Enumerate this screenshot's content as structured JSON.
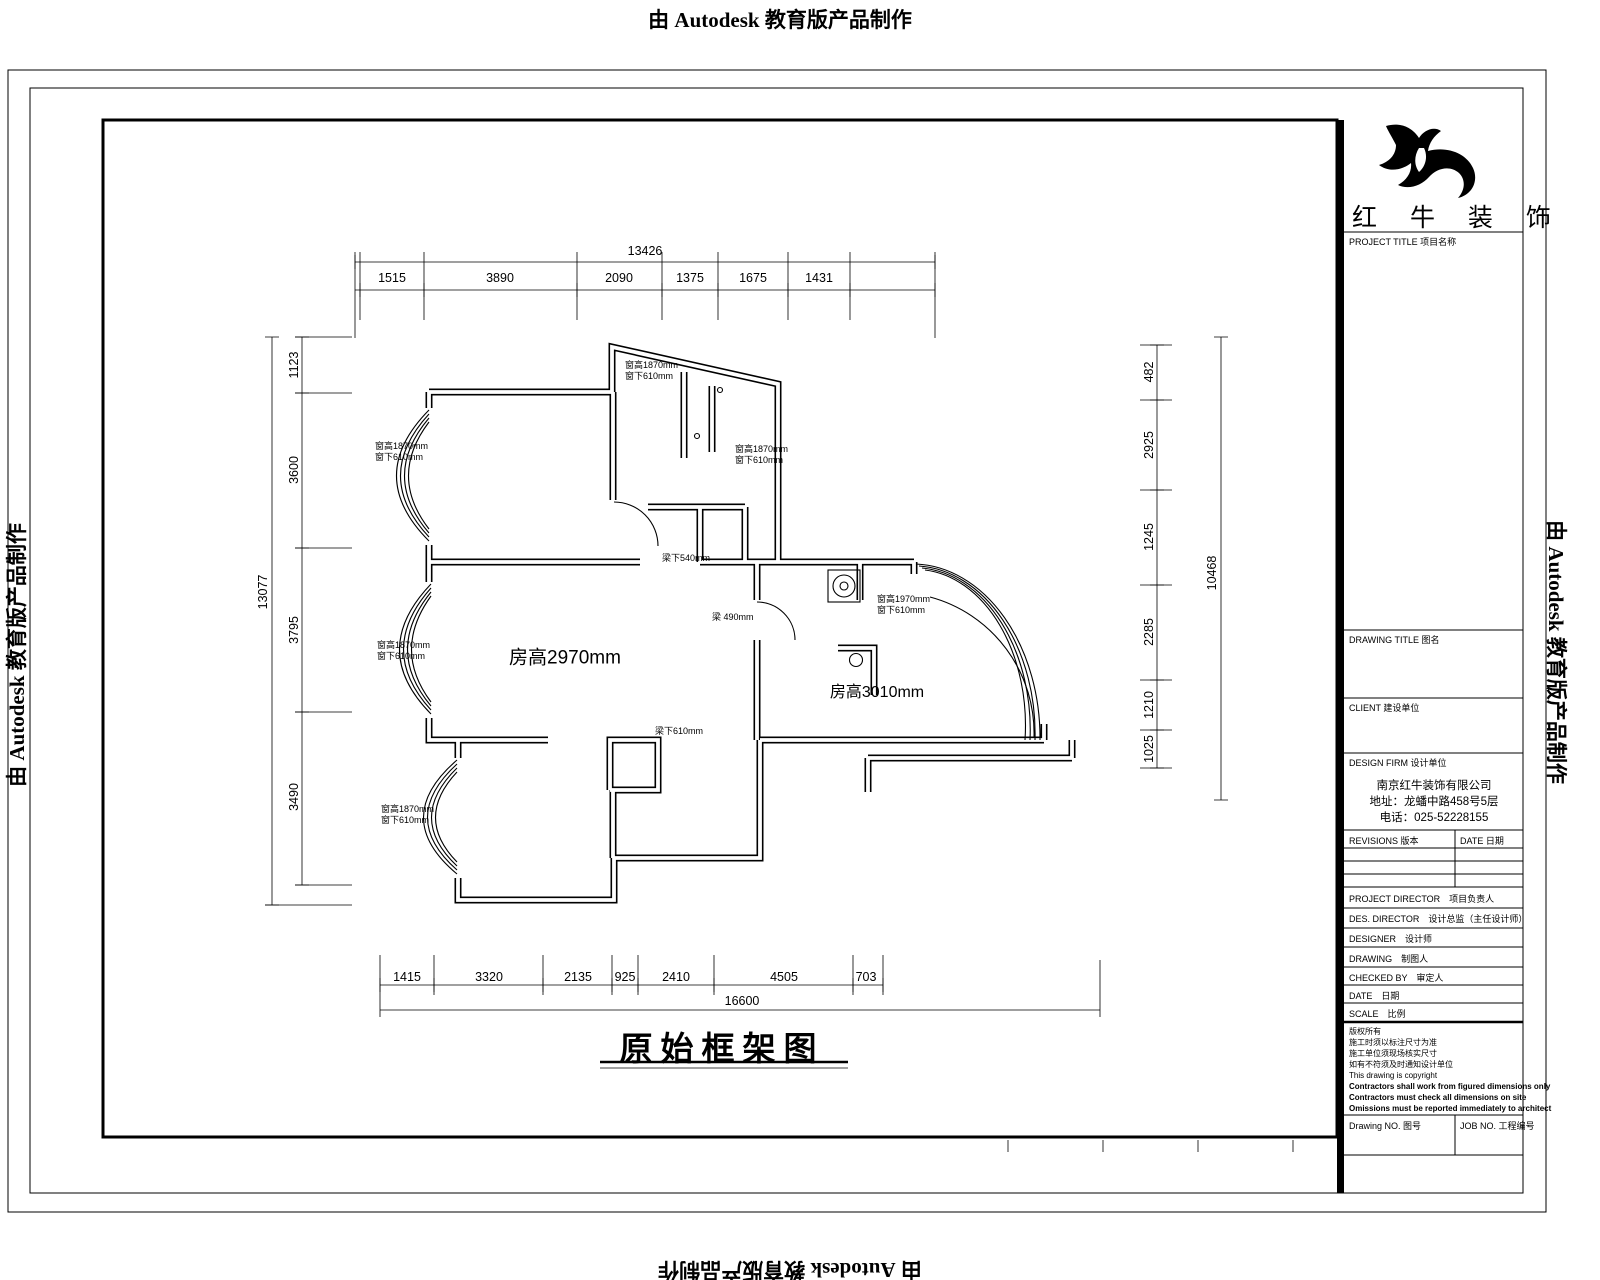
{
  "watermark": {
    "text": "由 Autodesk 教育版产品制作"
  },
  "plan": {
    "title": "原始框架图",
    "rooms": [
      {
        "label": "房高2970mm"
      },
      {
        "label": "房高3010mm"
      }
    ],
    "annotations": [
      {
        "l1": "窗高1870mm",
        "l2": "窗下610mm"
      },
      {
        "l1": "窗高1870mm",
        "l2": "窗下610mm"
      },
      {
        "l1": "窗高1870mm",
        "l2": "窗下610mm"
      },
      {
        "l1": "窗高1870mm",
        "l2": "窗下610mm"
      },
      {
        "l1": "窗高1870mm",
        "l2": "窗下610mm"
      },
      {
        "l1": "窗高1970mm",
        "l2": "窗下610mm"
      },
      {
        "l1": "梁下540mm",
        "l2": ""
      },
      {
        "l1": "梁 490mm",
        "l2": ""
      },
      {
        "l1": "梁下610mm",
        "l2": ""
      }
    ]
  },
  "dims": {
    "top": {
      "overall": "13426",
      "segments": [
        "1515",
        "3890",
        "2090",
        "1375",
        "1675",
        "1431"
      ]
    },
    "bottom": {
      "overall": "16600",
      "segments": [
        "1415",
        "3320",
        "2135",
        "925",
        "2410",
        "4505",
        "703"
      ]
    },
    "left": {
      "overall": "13077",
      "segments": [
        "1123",
        "3600",
        "3795",
        "3490"
      ]
    },
    "right": {
      "overall": "10468",
      "segments": [
        "482",
        "2925",
        "1245",
        "2285",
        "1210",
        "1025"
      ]
    }
  },
  "title_block": {
    "logo_text": "红 牛 装 饰",
    "project_title_label": "PROJECT TITLE 项目名称",
    "drawing_title_label": "DRAWING TITLE 图名",
    "client_label": "CLIENT 建设单位",
    "design_firm_label": "DESIGN FIRM 设计单位",
    "firm": {
      "name": "南京红牛装饰有限公司",
      "address": "地址：龙蟠中路458号5层",
      "phone": "电话：025-52228155"
    },
    "revisions_label": "REVISIONS 版本",
    "revision_date_label": "DATE 日期",
    "personnel_rows": [
      "PROJECT DIRECTOR　项目负责人",
      "DES. DIRECTOR　设计总监（主任设计师）",
      "DESIGNER　设计师",
      "DRAWING　制图人",
      "CHECKED BY　审定人",
      "DATE　日期",
      "SCALE　比例"
    ],
    "disclaimer": [
      "版权所有",
      "施工时须以标注尺寸为准",
      "施工单位须现场核实尺寸",
      "如有不符须及时通知设计单位",
      "This drawing is copyright",
      "Contractors shall work from figured dimensions only",
      "Contractors must check all dimensions on site",
      "Omissions must be reported immediately to architect"
    ],
    "drawing_no_label": "Drawing NO. 图号",
    "job_no_label": "JOB NO. 工程编号"
  }
}
